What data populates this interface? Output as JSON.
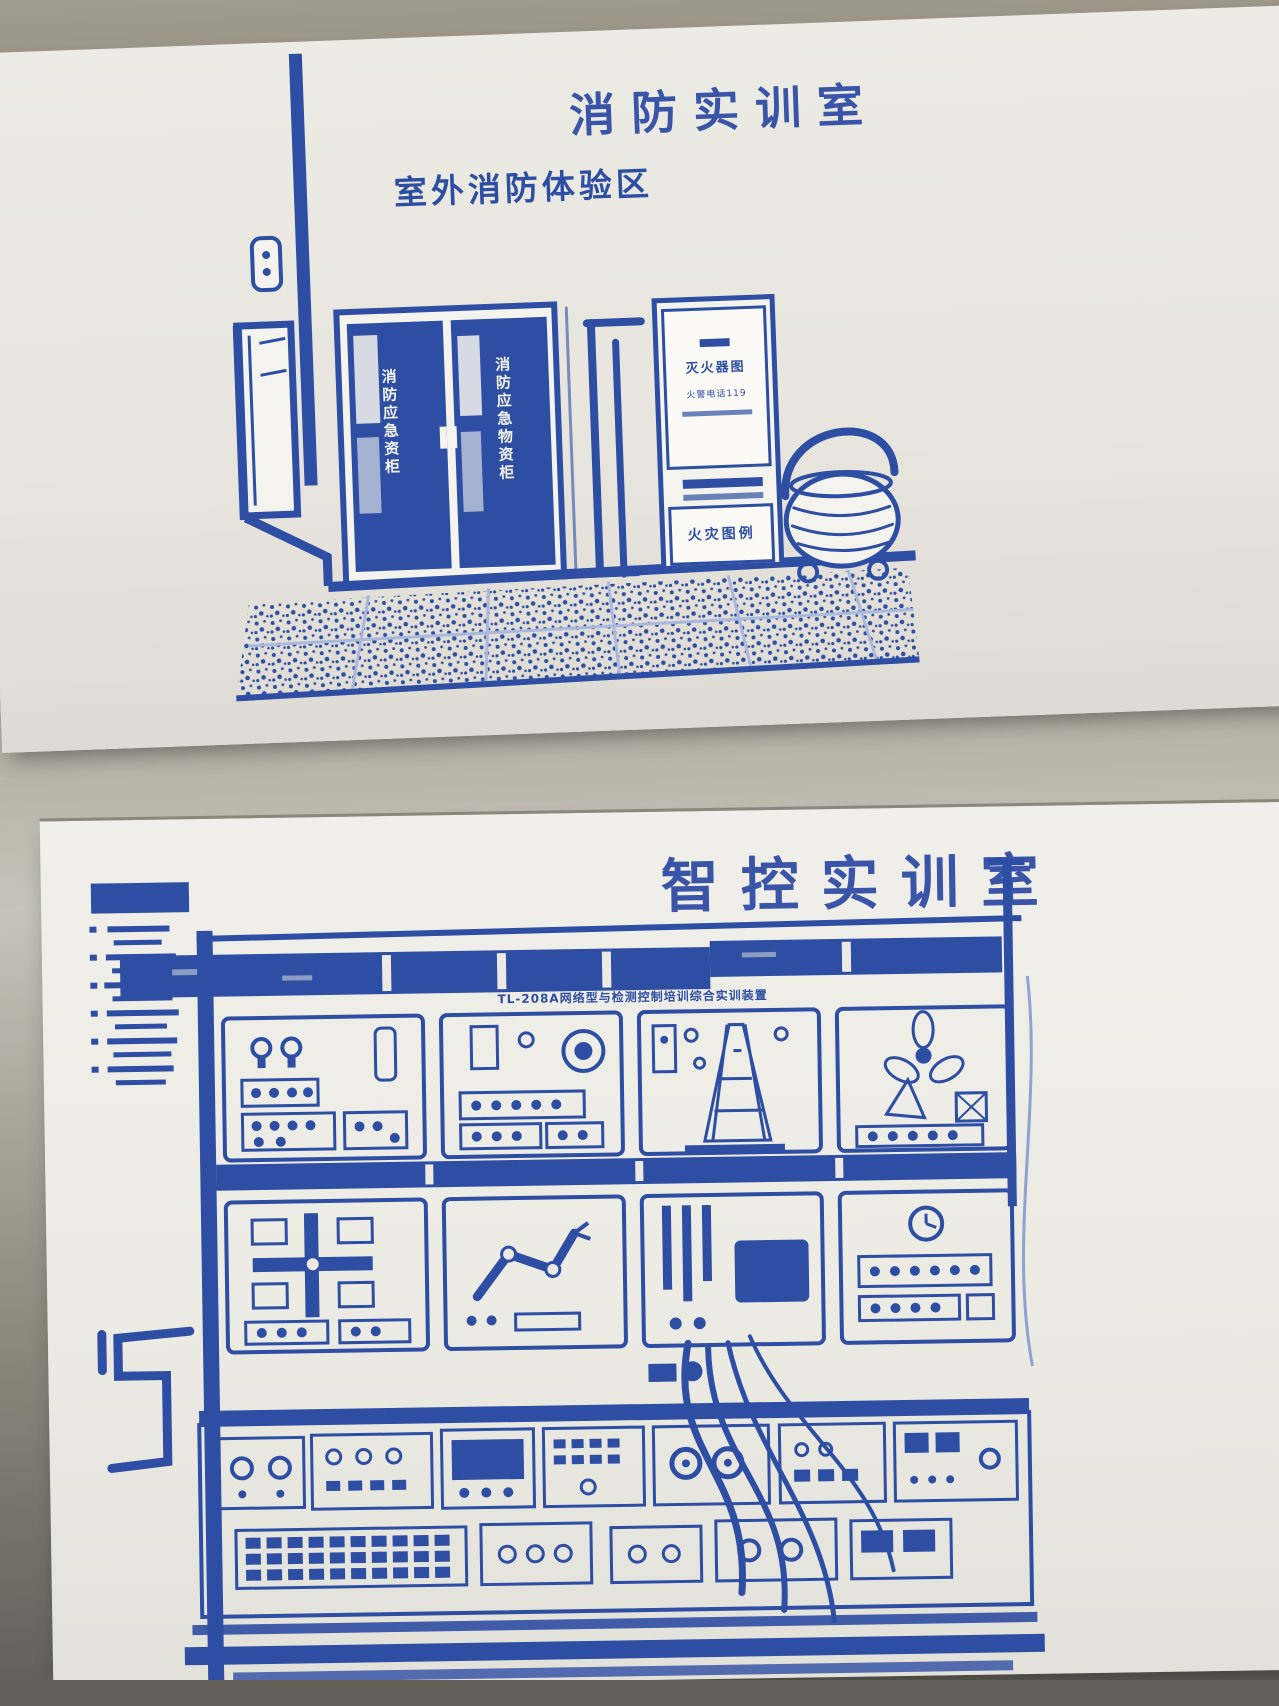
{
  "photo": {
    "ink_color": "#2e4ea3",
    "paper_color": "#edece6",
    "backdrop_color": "#958f85"
  },
  "fire_board": {
    "title": "消防实训室",
    "subtitle": "室外消防体验区",
    "cabinet_left_label": "消防应急资柜",
    "cabinet_right_label": "消防应急物资柜",
    "sign_top_line": "灭火器图",
    "sign_bottom_line": "火警电话119",
    "lower_sign": "火灾图例"
  },
  "control_board": {
    "title": "智控实训室",
    "nameplate": "TL-208A网络型与检测控制培训综合实训装置"
  }
}
